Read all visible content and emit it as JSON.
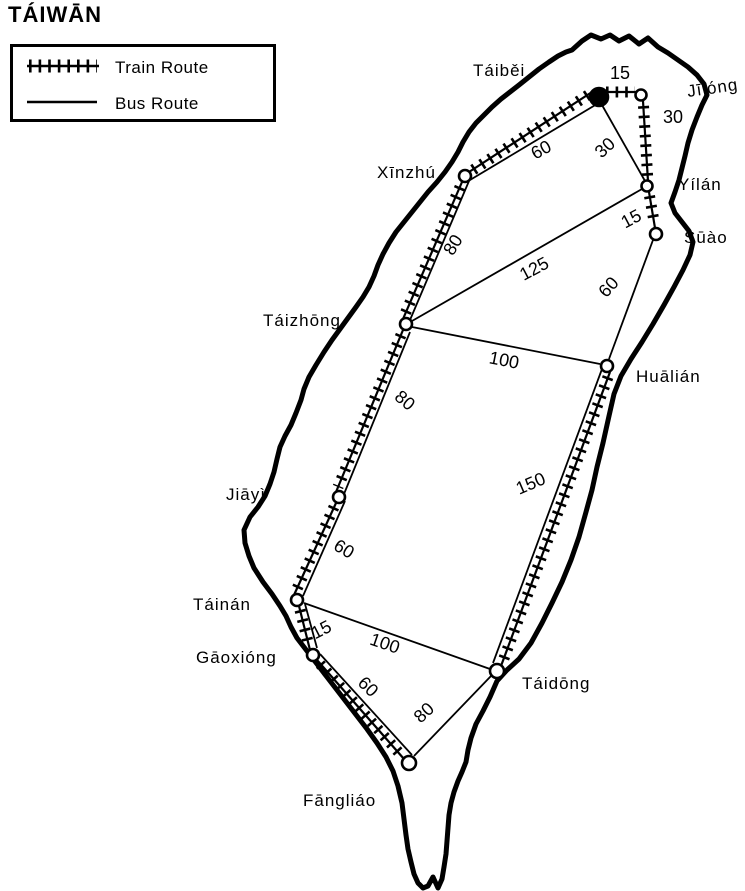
{
  "title": "TÁIWĀN",
  "legend": {
    "train": "Train Route",
    "bus": "Bus Route"
  },
  "colors": {
    "ink": "#000000",
    "paper": "#ffffff"
  },
  "cities": [
    {
      "name": "Táiběi"
    },
    {
      "name": "Jīlóng"
    },
    {
      "name": "Yílán"
    },
    {
      "name": "Sūào"
    },
    {
      "name": "Xīnzhú"
    },
    {
      "name": "Táizhōng"
    },
    {
      "name": "Huālián"
    },
    {
      "name": "Jiāyì"
    },
    {
      "name": "Táinán"
    },
    {
      "name": "Gāoxióng"
    },
    {
      "name": "Fāngliáo"
    },
    {
      "name": "Táidōng"
    }
  ],
  "routes": [
    {
      "from": "Táiběi",
      "to": "Jīlóng",
      "mode": "train",
      "time": "15"
    },
    {
      "from": "Jīlóng",
      "to": "Yílán",
      "mode": "train",
      "time": "30"
    },
    {
      "from": "Yílán",
      "to": "Sūào",
      "mode": "train",
      "time": "15"
    },
    {
      "from": "Táiběi",
      "to": "Yílán",
      "mode": "bus",
      "time": "30"
    },
    {
      "from": "Táiběi",
      "to": "Xīnzhú",
      "mode": "train+bus",
      "time": "60"
    },
    {
      "from": "Xīnzhú",
      "to": "Táizhōng",
      "mode": "train+bus",
      "time": "80"
    },
    {
      "from": "Táizhōng",
      "to": "Yílán",
      "mode": "bus",
      "time": "125"
    },
    {
      "from": "Táizhōng",
      "to": "Huālián",
      "mode": "bus",
      "time": "100"
    },
    {
      "from": "Sūào",
      "to": "Huālián",
      "mode": "bus",
      "time": "60"
    },
    {
      "from": "Huālián",
      "to": "Táidōng",
      "mode": "train+bus",
      "time": "150"
    },
    {
      "from": "Táizhōng",
      "to": "Jiāyì",
      "mode": "train+bus",
      "time": "80"
    },
    {
      "from": "Jiāyì",
      "to": "Táinán",
      "mode": "train+bus",
      "time": "60"
    },
    {
      "from": "Táinán",
      "to": "Gāoxióng",
      "mode": "train+bus",
      "time": "15"
    },
    {
      "from": "Gāoxióng",
      "to": "Fāngliáo",
      "mode": "train+bus",
      "time": "60"
    },
    {
      "from": "Táinán",
      "to": "Táidōng",
      "mode": "bus",
      "time": "100"
    },
    {
      "from": "Fāngliáo",
      "to": "Táidōng",
      "mode": "bus",
      "time": "80"
    }
  ]
}
